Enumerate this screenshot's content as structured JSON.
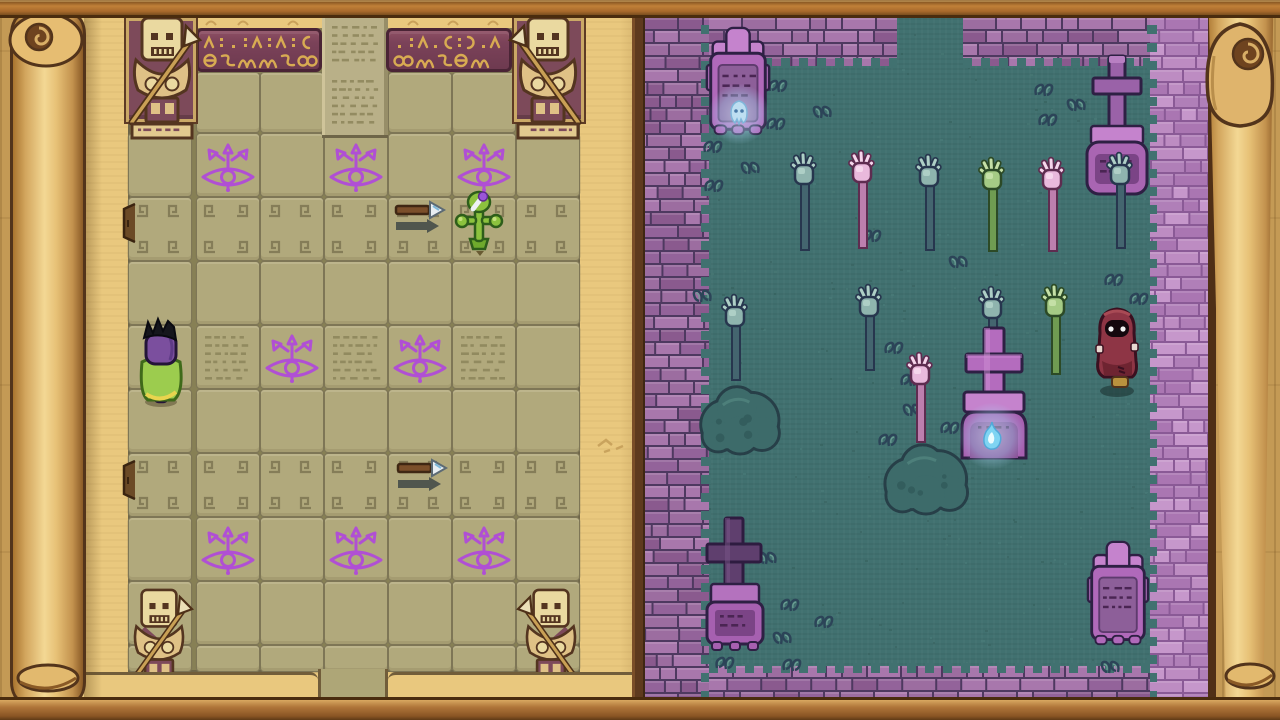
{
  "scene": {
    "left_panel": "temple-map-scroll",
    "right_panel": "graveyard-view",
    "visible_text": ""
  },
  "palette": {
    "wood": "#c49a55",
    "frame_mid": "#b0763a",
    "frame_dark": "#4a2c0e",
    "frame_light": "#d9a159",
    "parchment": "#e9c87e",
    "parchment_line": "#715d3a",
    "roll": "#ecca80",
    "roll_dark": "#53341b",
    "roll_cap": "#6e431f",
    "roll_swirl": "#d8ae67",
    "map_bg": "#878055",
    "map_cell": "#b1a97c",
    "map_line": "#7e7656",
    "map_border": "#6e6548",
    "banner": "#7b4259",
    "banner_dark": "#4a2435",
    "banner_gold": "#d8ab52",
    "niche": "#7d4a5a",
    "niche_frame": "#caa866",
    "statue_body": "#ead9a0",
    "statue_arm": "#dfc186",
    "statue_dark": "#543520",
    "statue_maroon": "#7d4a5a",
    "spear": "#c9a055",
    "spear_tip": "#ece0b8",
    "eye": "#b04fd4",
    "meander": "#857d58",
    "glyph_text": "#8a8258",
    "grass": "#417170",
    "grass_dark": "#38625f",
    "grass_light": "#4b7d79",
    "wall_mortar": "#4e3960",
    "wall_edge": "#2c1f42",
    "wall_r_mortar": "#8a5a96",
    "tomb_pink": "#c583cd",
    "tomb_mid": "#b069ba",
    "tomb_panel": "#8d5f99",
    "tomb_panel_dark": "#7b4486",
    "tomb_outline": "#2e2044",
    "tomb_engrave": "#4a2553",
    "tomb_cross_dark": "#5f3f6e",
    "hand_outline": "#27364e",
    "bush": "#3d6b6a",
    "bush_dark": "#273f48",
    "orb_flame": "#7fd4f2",
    "orb_core": "#eafcff",
    "npc_red": "#8e3545",
    "npc_red_dark": "#6e2431",
    "npc_outline": "#3a1020",
    "player_purple": "#7b4f9e",
    "player_cape": "#9ccc4e",
    "player_trim": "#e8d44e"
  },
  "map": {
    "panel": [
      44,
      14,
      600,
      688
    ],
    "grid": {
      "x": 128,
      "y": 15,
      "w": 452,
      "h": 657,
      "cols": [
        128,
        196,
        260,
        324,
        388,
        452,
        516
      ],
      "rows": [
        [
          133,
          64
        ],
        [
          197,
          64
        ],
        [
          261,
          64
        ],
        [
          325,
          64
        ],
        [
          389,
          64
        ],
        [
          453,
          64
        ],
        [
          517,
          64
        ],
        [
          581,
          64
        ],
        [
          645,
          27
        ]
      ],
      "top_band": {
        "y": 72,
        "h": 61,
        "cols": [
          196,
          260,
          388,
          452
        ]
      }
    },
    "banner_segments": [
      [
        196,
        28,
        126,
        44
      ],
      [
        386,
        28,
        126,
        44
      ]
    ],
    "column_tile": [
      322,
      15,
      66,
      120
    ],
    "niches": [
      [
        126,
        18,
        70,
        104
      ],
      [
        514,
        18,
        70,
        104
      ]
    ],
    "statues": [
      {
        "x": 120,
        "y": 10,
        "w": 84,
        "h": 130,
        "mirror": false,
        "pedestal": true
      },
      {
        "x": 506,
        "y": 10,
        "w": 84,
        "h": 130,
        "mirror": true,
        "pedestal": true
      },
      {
        "x": 122,
        "y": 583,
        "w": 74,
        "h": 100,
        "mirror": false,
        "pedestal": false
      },
      {
        "x": 514,
        "y": 583,
        "w": 74,
        "h": 100,
        "mirror": true,
        "pedestal": false
      }
    ],
    "eyes": [
      [
        228,
        166
      ],
      [
        356,
        166
      ],
      [
        484,
        166
      ],
      [
        292,
        357
      ],
      [
        420,
        357
      ],
      [
        228,
        549
      ],
      [
        356,
        549
      ],
      [
        484,
        549
      ]
    ],
    "text_tiles": [
      [
        327,
        20,
        56,
        50
      ],
      [
        327,
        74,
        56,
        56
      ],
      [
        200,
        330,
        56,
        54
      ],
      [
        328,
        330,
        56,
        54
      ],
      [
        456,
        330,
        56,
        54
      ]
    ],
    "meander_rows": [
      197,
      453
    ],
    "doors": [
      [
        119,
        202
      ],
      [
        119,
        459
      ]
    ],
    "darts": [
      [
        394,
        200
      ],
      [
        396,
        458
      ]
    ],
    "flower": [
      454,
      191
    ],
    "player": [
      134,
      316
    ],
    "cracks": [
      [
        596,
        436
      ]
    ],
    "bottom_tab": [
      318,
      669,
      70,
      31
    ]
  },
  "graveyard": {
    "panel": [
      645,
      18,
      563,
      682
    ],
    "walls": [
      {
        "name": "wall-left",
        "x": 0,
        "y": 0,
        "w": 64,
        "h": 682,
        "pal": "std",
        "edge": "right"
      },
      {
        "name": "wall-top-a",
        "x": 64,
        "y": 0,
        "w": 188,
        "h": 48,
        "pal": "std",
        "edge": "bottom"
      },
      {
        "name": "wall-top-b",
        "x": 318,
        "y": 0,
        "w": 187,
        "h": 48,
        "pal": "std",
        "edge": "bottom"
      },
      {
        "name": "wall-right",
        "x": 505,
        "y": 0,
        "w": 58,
        "h": 682,
        "pal": "light",
        "edge": "left"
      },
      {
        "name": "wall-bottom",
        "x": 64,
        "y": 648,
        "w": 441,
        "h": 34,
        "pal": "std",
        "edge": "top"
      }
    ],
    "tombs": [
      {
        "type": "ornate",
        "x": 61,
        "y": 8,
        "h": 112
      },
      {
        "type": "cross",
        "x": 441,
        "y": 36,
        "h": 142
      },
      {
        "type": "big-cross",
        "x": 309,
        "y": 308,
        "h": 132
      },
      {
        "type": "cross-dark",
        "x": 57,
        "y": 498,
        "h": 134
      },
      {
        "type": "ornate",
        "x": 441,
        "y": 522,
        "h": 108
      }
    ],
    "hands": [
      {
        "x": 139,
        "y": 130,
        "c": "teal",
        "len": 68
      },
      {
        "x": 197,
        "y": 128,
        "c": "pink",
        "len": 68
      },
      {
        "x": 264,
        "y": 132,
        "c": "teal",
        "len": 66
      },
      {
        "x": 327,
        "y": 135,
        "c": "green",
        "len": 64
      },
      {
        "x": 387,
        "y": 135,
        "c": "pink",
        "len": 64
      },
      {
        "x": 455,
        "y": 130,
        "c": "teal",
        "len": 66
      },
      {
        "x": 70,
        "y": 272,
        "c": "teal",
        "len": 56
      },
      {
        "x": 204,
        "y": 262,
        "c": "teal",
        "len": 56
      },
      {
        "x": 327,
        "y": 264,
        "c": "teal",
        "len": 38,
        "behind": true
      },
      {
        "x": 390,
        "y": 262,
        "c": "green",
        "len": 60
      },
      {
        "x": 255,
        "y": 330,
        "c": "pink",
        "len": 60
      }
    ],
    "bushes": [
      [
        56,
        366,
        78,
        70
      ],
      [
        239,
        424,
        84,
        72
      ]
    ],
    "orbs": [
      {
        "x": 94,
        "y": 96,
        "r": 30,
        "kind": "wisp"
      },
      {
        "x": 347,
        "y": 418,
        "r": 33,
        "kind": "flame"
      }
    ],
    "tufts": [
      [
        121,
        58
      ],
      [
        167,
        84
      ],
      [
        119,
        96
      ],
      [
        56,
        119
      ],
      [
        95,
        140
      ],
      [
        57,
        158
      ],
      [
        387,
        62
      ],
      [
        421,
        77
      ],
      [
        391,
        92
      ],
      [
        215,
        208
      ],
      [
        303,
        234
      ],
      [
        457,
        252
      ],
      [
        482,
        271
      ],
      [
        47,
        268
      ],
      [
        237,
        320
      ],
      [
        253,
        352
      ],
      [
        257,
        382
      ],
      [
        293,
        400
      ],
      [
        231,
        412
      ],
      [
        112,
        530
      ],
      [
        133,
        577
      ],
      [
        167,
        594
      ],
      [
        127,
        610
      ],
      [
        68,
        635
      ],
      [
        135,
        637
      ],
      [
        455,
        639
      ]
    ],
    "npc": {
      "x": 443,
      "y": 285
    }
  },
  "rolls": {
    "left": [
      10,
      14,
      76,
      688
    ],
    "right": [
      1206,
      14,
      70,
      688
    ]
  },
  "frames": {
    "top": [
      0,
      0,
      1280,
      18
    ],
    "bottom": [
      0,
      697,
      1280,
      23
    ]
  }
}
